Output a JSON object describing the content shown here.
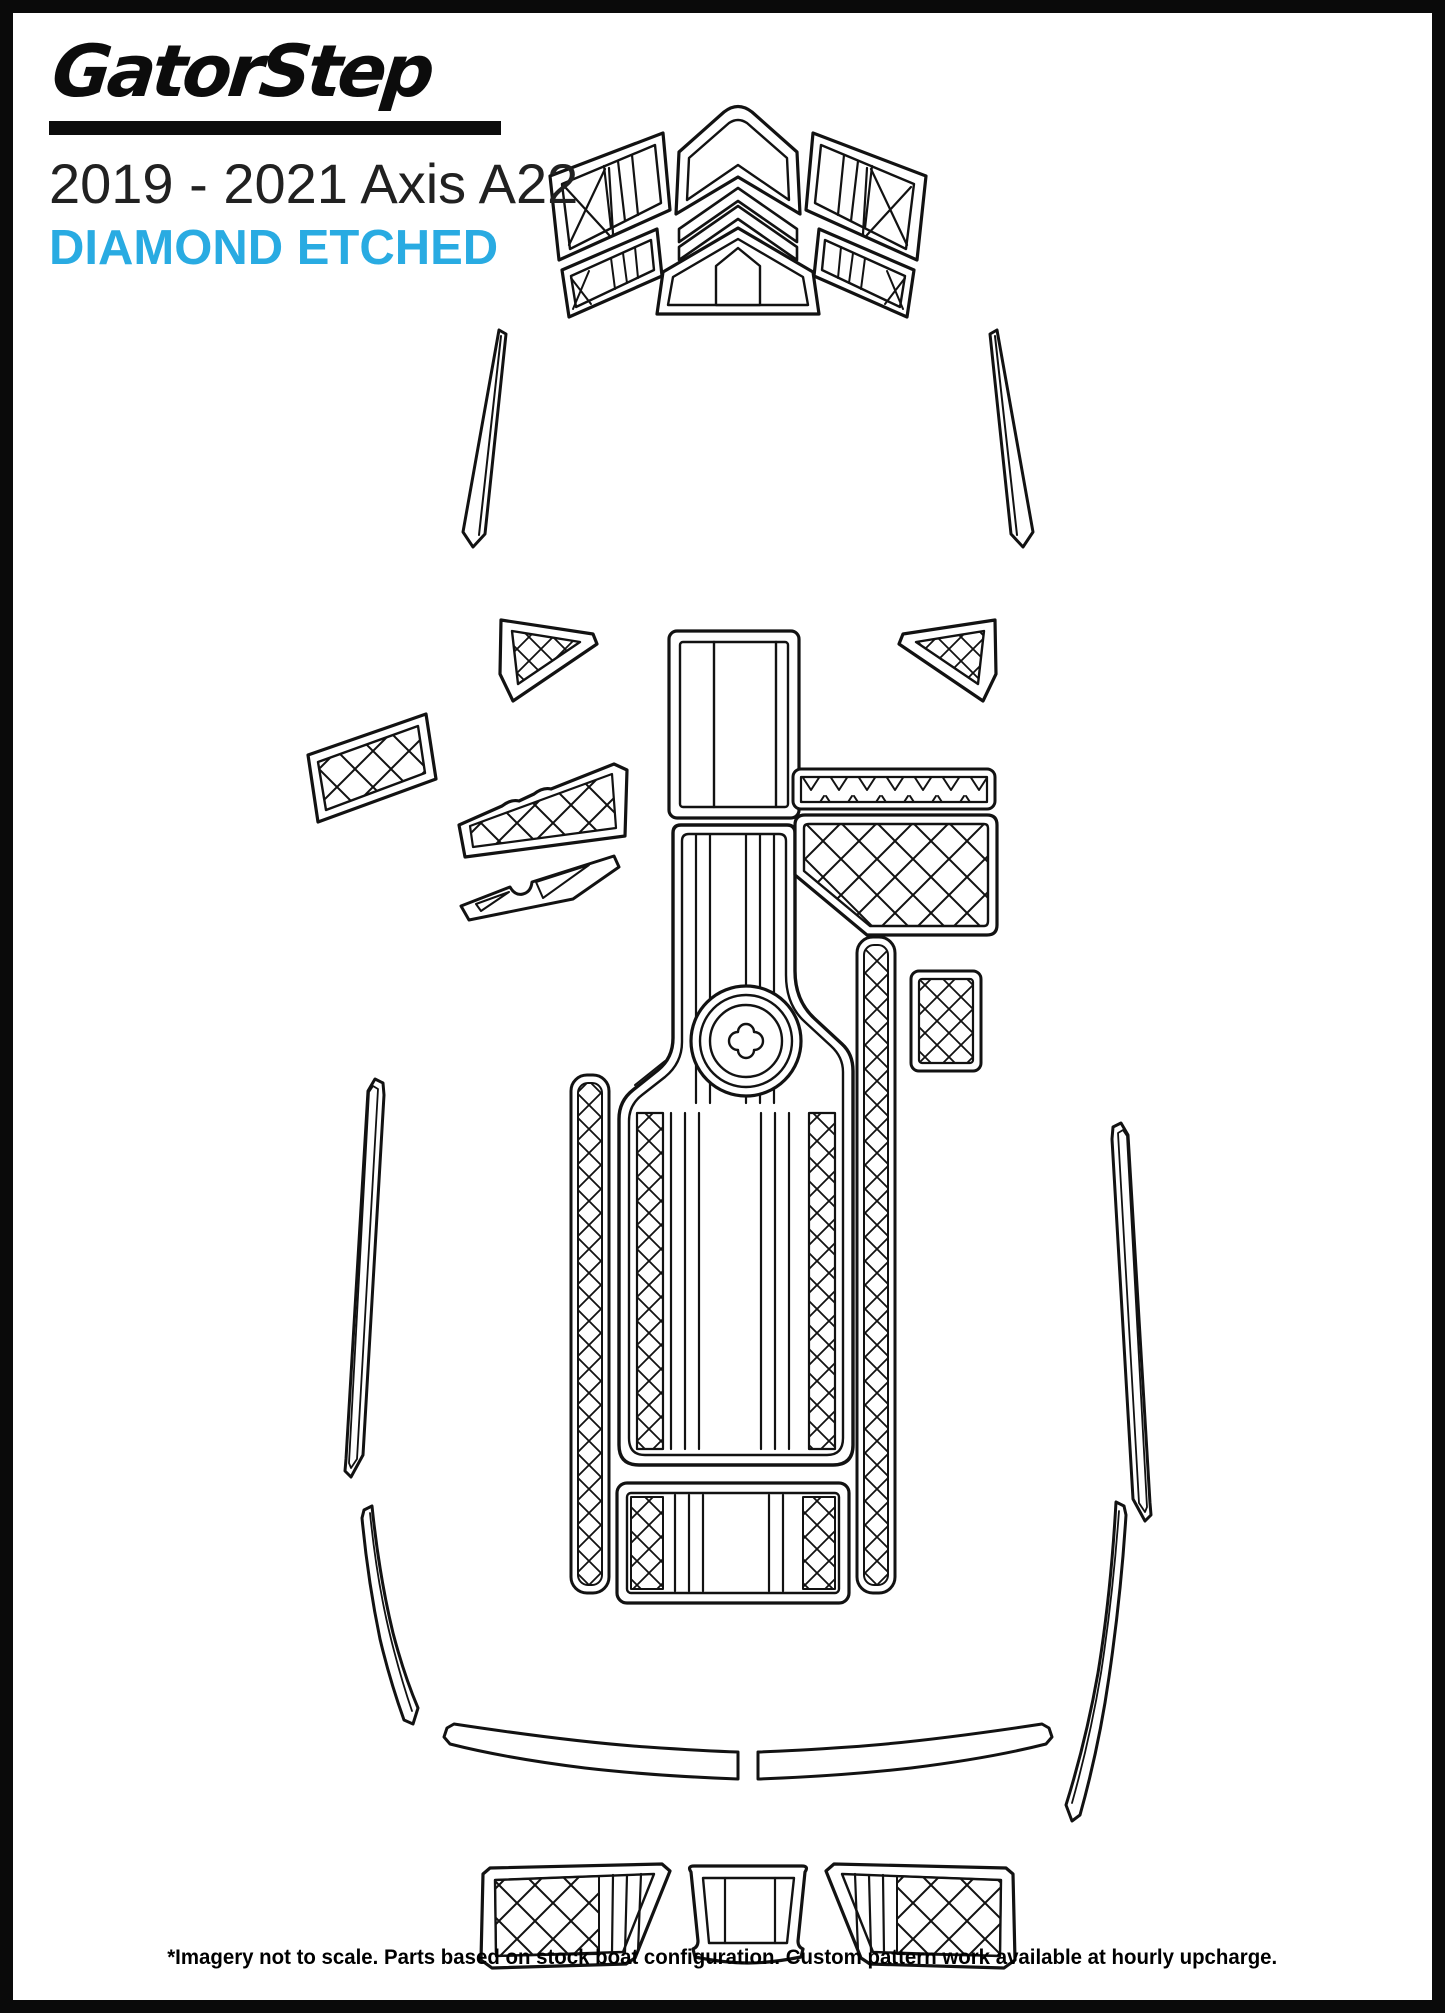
{
  "page": {
    "background": "#ffffff",
    "frame_color": "#0a0a0a"
  },
  "header": {
    "logo_text": "GatorStep",
    "title": "2019 - 2021 Axis A22",
    "subtitle": "DIAMOND ETCHED",
    "subtitle_color": "#29ABE2",
    "text_color": "#212121"
  },
  "footer": {
    "disclaimer": "*Imagery not to scale. Parts based on stock boat configuration. Custom pattern work available at hourly upcharge."
  },
  "diagram": {
    "stroke_color": "#121212",
    "pattern_styles": [
      "diamond-lattice",
      "zigzag-triangles",
      "vertical-stripes",
      "x-cross"
    ],
    "parts": [
      "bow-port-upper-pad",
      "bow-port-lower-pad",
      "bow-center-upper-pad",
      "bow-chevron-band-1",
      "bow-chevron-band-2",
      "bow-center-lower-pad",
      "bow-starboard-upper-pad",
      "bow-starboard-lower-pad",
      "windshield-port-strip",
      "windshield-starboard-strip",
      "port-triangle-pad",
      "starboard-triangle-pad",
      "port-bow-step-pad",
      "port-sidewall-upper-pad",
      "port-sidewall-lower-pad",
      "walkway-top-pad",
      "main-floor-pad",
      "ski-pylon-circle",
      "rear-bench-pad",
      "port-border-strip",
      "starboard-border-strip",
      "starboard-zigzag-strip",
      "starboard-locker-pad",
      "starboard-small-pad",
      "port-gunwale-strip",
      "starboard-gunwale-strip",
      "port-rear-curved-strip",
      "starboard-rear-curved-strip",
      "swim-platform-port-half",
      "swim-platform-starboard-half",
      "transom-port-pad",
      "transom-center-pad",
      "transom-starboard-pad"
    ]
  }
}
